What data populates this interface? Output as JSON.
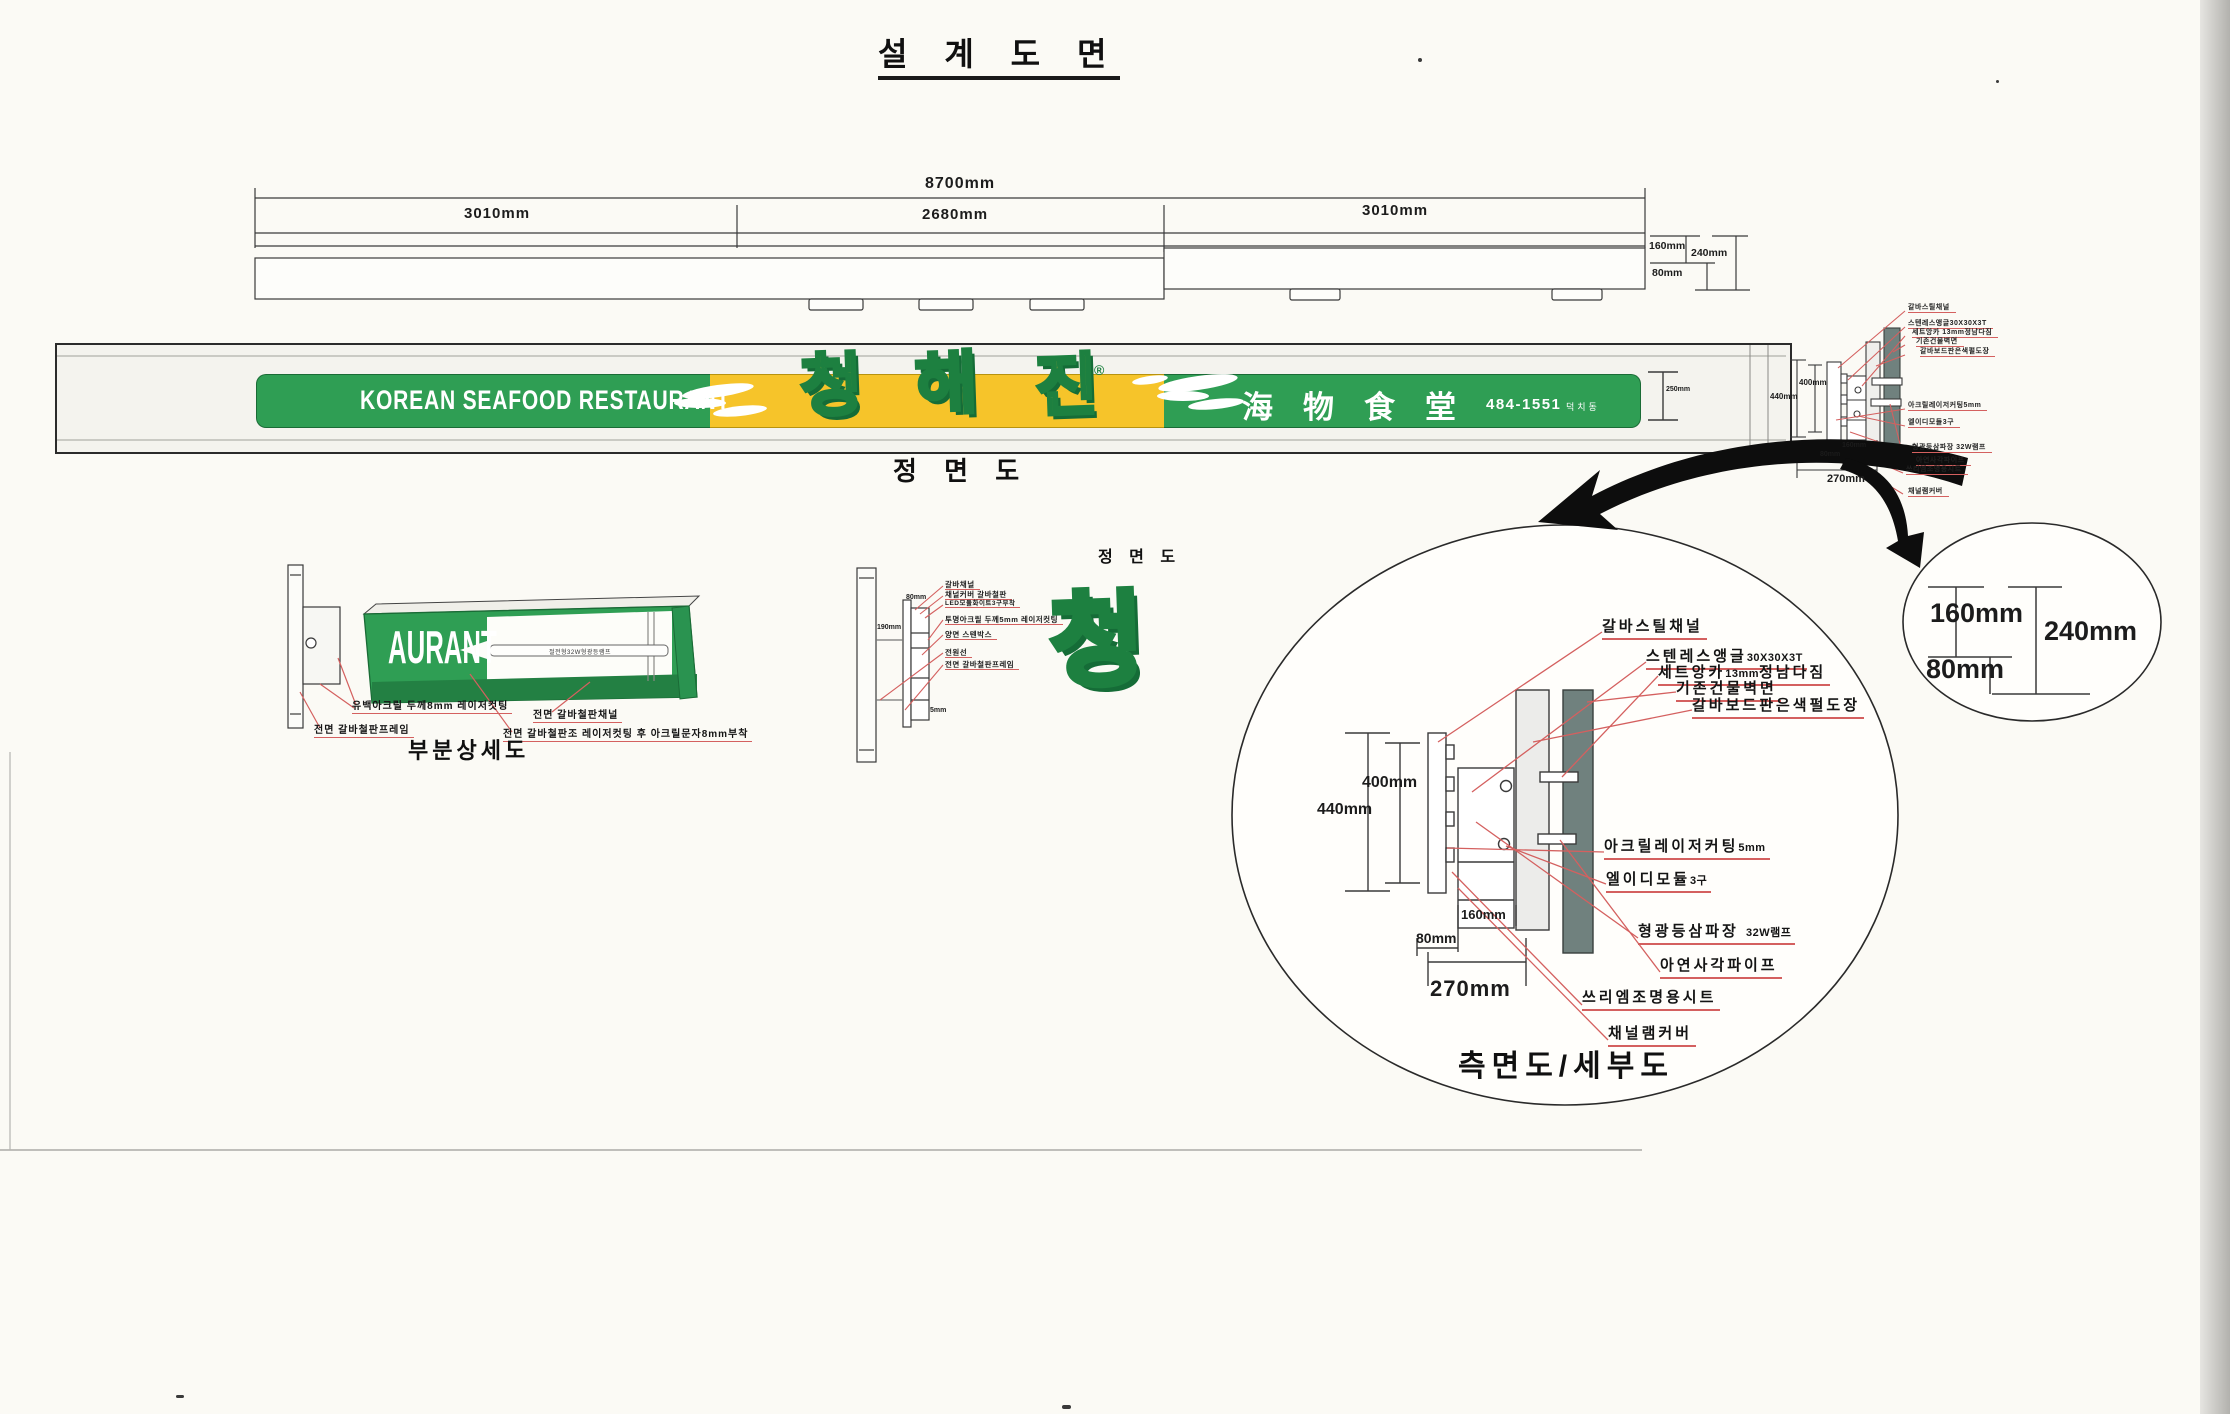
{
  "page": {
    "title": "설 계 도 면"
  },
  "plan_view": {
    "total": "8700mm",
    "seg_left": "3010mm",
    "seg_center": "2680mm",
    "seg_right": "3010mm",
    "d160": "160mm",
    "d240": "240mm",
    "d80": "80mm"
  },
  "front_view": {
    "label": "정 면 도",
    "english": "KOREAN SEAFOOD RESTAURANT",
    "kor1": "청",
    "kor2": "해",
    "kor3": "진",
    "registered": "®",
    "hanja": "海物食堂",
    "phone": "484-1551",
    "phone_suffix": "덕치동",
    "height_dim": "250mm"
  },
  "mini_side_view": {
    "d440": "440mm",
    "d400": "400mm",
    "d160": "160mm",
    "d80": "80mm",
    "d270": "270mm",
    "labels": [
      "갈바스틸채널",
      "스텐레스앵글30X30X3T",
      "세트앙카 13mm정남다짐",
      "기존건물벽면",
      "갈바보드판은색펄도장",
      "아크릴레이저커팅5mm",
      "엘이디모듈3구",
      "형광등삼파장 32W램프",
      "아연사각파이프",
      "쓰리엠조명용시트",
      "채널램커버"
    ]
  },
  "partial_detail": {
    "title": "부분상세도",
    "panel_text": "AURANT",
    "lamp_text": "절전형32W형광등램프",
    "label_acrylic": "유백아크릴 두께8mm 레이저컷팅",
    "label_frame": "전면 갈바철판프레임",
    "label_channel": "전면 갈바철판채널",
    "label_cutting": "전면 갈바철판조 레이저컷팅 후 아크릴문자8mm부착"
  },
  "channel_detail": {
    "label": "정 면 도",
    "letter": "청",
    "d80": "80mm",
    "d190": "190mm",
    "d5": "5mm",
    "labels": [
      "갈바채널",
      "채널커버 갈바철판",
      "LED모듈화이트3구부착",
      "투명아크릴 두께5mm 레이저컷팅",
      "양면 스텐박스",
      "전원선",
      "전면 갈바철판프레임"
    ]
  },
  "side_detail": {
    "title": "측면도/세부도",
    "d400": "400mm",
    "d440": "440mm",
    "d160": "160mm",
    "d80": "80mm",
    "d270": "270mm",
    "labels": [
      {
        "main": "갈바스틸채널"
      },
      {
        "main": "스텐레스앵글",
        "small": "30X30X3T"
      },
      {
        "main": "세트앙카",
        "small": "13mm",
        "tail": "정남다짐"
      },
      {
        "main": "기존건물벽면"
      },
      {
        "main": "갈바보드판은색펄도장"
      },
      {
        "main": "아크릴레이저커팅",
        "small": "5mm"
      },
      {
        "main": "엘이디모듈",
        "small": "3구"
      },
      {
        "main": "형광등삼파장",
        "small": "32W램프"
      },
      {
        "main": "아연사각파이프"
      },
      {
        "main": "쓰리엠조명용시트"
      },
      {
        "main": "채널램커버"
      }
    ]
  },
  "corner_detail": {
    "d160": "160mm",
    "d240": "240mm",
    "d80": "80mm"
  },
  "colors": {
    "sign_green": "#2f9e54",
    "sign_green_dark": "#1d8040",
    "sign_yellow": "#f6c42a",
    "leader_red": "#d4605f"
  }
}
